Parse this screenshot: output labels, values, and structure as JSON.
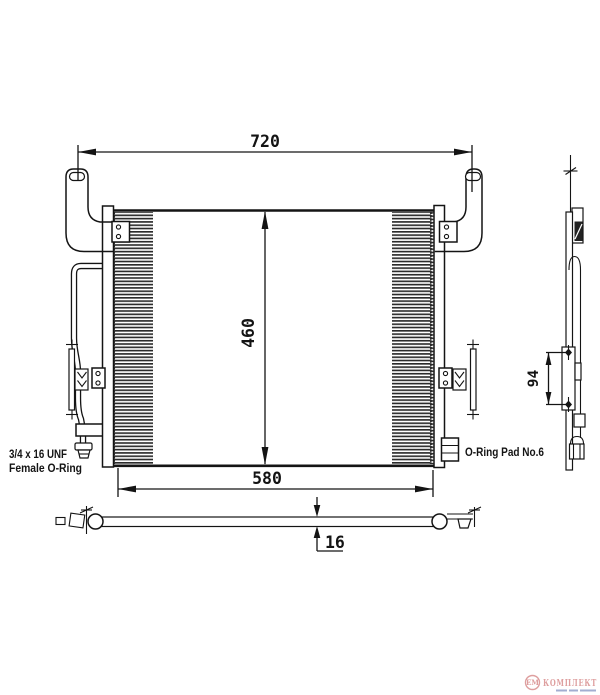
{
  "drawing": {
    "type": "technical-diagram",
    "subject": "air-conditioning condenser with mounting brackets",
    "dimensions": {
      "overall_width": "720",
      "core_height": "460",
      "core_width": "580",
      "bracket_pitch": "94",
      "depth": "16"
    },
    "labels": {
      "left_fitting_line1": "3/4 x 16 UNF",
      "left_fitting_line2": "Female O-Ring",
      "right_fitting": "O-Ring Pad No.6"
    },
    "logo": {
      "mark": "ЕМ",
      "name": "КОМПЛЕКТ"
    },
    "colors": {
      "line": "#141414",
      "background": "#ffffff",
      "fin_stripe": "#2b2b2b",
      "logo_primary": "#d98f8f",
      "logo_secondary": "#93a1c9"
    }
  }
}
